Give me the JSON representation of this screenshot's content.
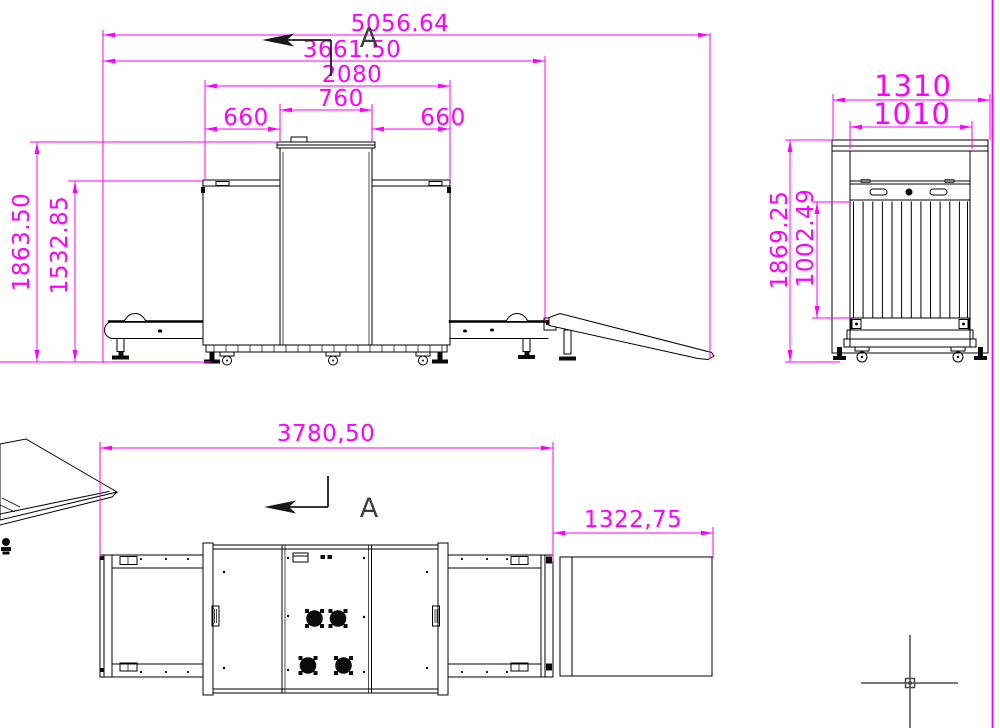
{
  "style": {
    "background": "#ffffff",
    "dimension_color": "#ff00ff",
    "drawing_color": "#000000",
    "annotation_color": "#3d3d3d",
    "cursor_color": "#4a4a4a",
    "viewport_border_color": "#ff00ff"
  },
  "front_view": {
    "dimensions": {
      "overall_length": "5056.64",
      "length_to_exit": "3661.50",
      "cabinet_length": "2080",
      "top_tower_width": "760",
      "top_left_panel": "660",
      "top_right_panel": "660",
      "overall_height": "1863.50",
      "cabinet_height": "1532.85"
    },
    "section_label": "A"
  },
  "end_view": {
    "dimensions": {
      "overall_width": "1310",
      "body_width": "1010",
      "overall_height": "1869.25",
      "tunnel_height": "1002.49"
    }
  },
  "plan_view": {
    "dimensions": {
      "cabinet_with_conveyors_length": "3780,50",
      "exit_table_length": "1322,75"
    },
    "section_label": "A"
  }
}
